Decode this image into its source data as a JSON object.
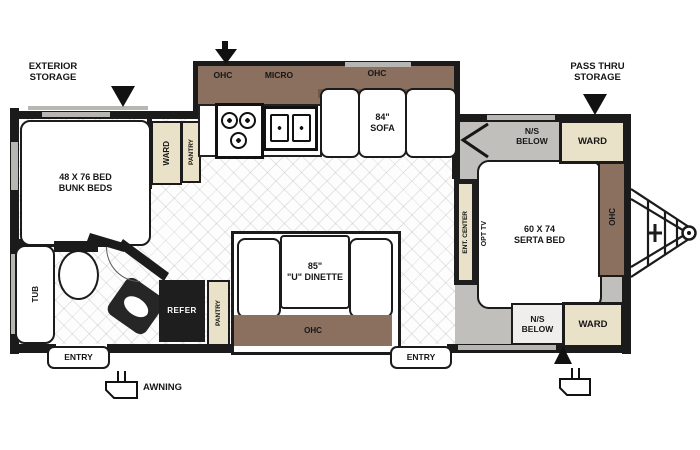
{
  "title": "Travel Trailer Floor Plan",
  "callouts": {
    "exterior_storage_line1": "EXTERIOR",
    "exterior_storage_line2": "STORAGE",
    "pass_thru_line1": "PASS THRU",
    "pass_thru_line2": "STORAGE",
    "awning": "AWNING",
    "entry_left": "ENTRY",
    "entry_right": "ENTRY"
  },
  "bunk_room": {
    "bed_size": "48 X 76 BED",
    "bed_name": "BUNK BEDS",
    "ward": "WARD",
    "pantry": "PANTRY"
  },
  "bathroom": {
    "tub": "TUB"
  },
  "kitchen": {
    "ohc": "OHC",
    "micro": "MICRO",
    "refer": "REFER",
    "pantry": "PANTRY"
  },
  "sofa": {
    "ohc": "OHC",
    "size": "84\"",
    "name": "SOFA"
  },
  "dinette": {
    "size": "85\"",
    "name": "\"U\" DINETTE",
    "ohc": "OHC"
  },
  "bedroom": {
    "bed_size": "60 X 74",
    "bed_name": "SERTA BED",
    "opt_tv": "OPT TV",
    "ent_center": "ENT. CENTER",
    "ohc": "OHC",
    "ns_top_line1": "N/S",
    "ns_top_line2": "BELOW",
    "ns_bottom_line1": "N/S",
    "ns_bottom_line2": "BELOW",
    "ward_top": "WARD",
    "ward_bottom": "WARD"
  },
  "colors": {
    "wall": "#1b1b1b",
    "cabinet_brown": "#8b7060",
    "cabinet_brown_dark": "#6e5a4d",
    "tan": "#e9e2c9",
    "floor_gray": "#c1bfbb",
    "appliance_dark": "#1e1e1e"
  }
}
